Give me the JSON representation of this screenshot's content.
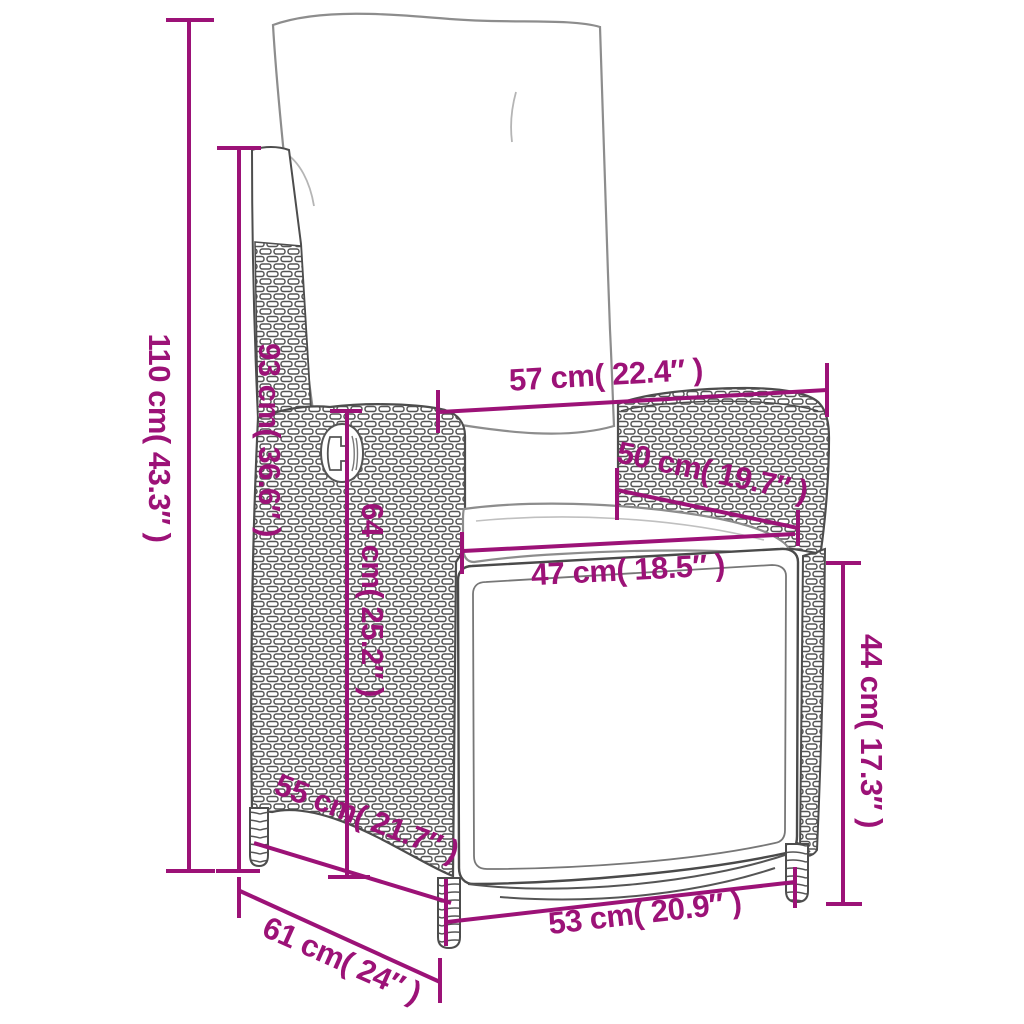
{
  "meta": {
    "type": "product-dimension-diagram",
    "subject": "reclining wicker garden chair with back and seat cushions, line drawing",
    "colors": {
      "dimension_accent": "#9C1277",
      "line_art": "#4d4d4d",
      "background": "#ffffff"
    }
  },
  "dims": [
    {
      "id": "overall-height",
      "label": "110 cm( 43.3″ )"
    },
    {
      "id": "backrest-height",
      "label": "93 cm( 36.6″ )"
    },
    {
      "id": "back-width",
      "label": "57 cm( 22.4″ )"
    },
    {
      "id": "armrest-length",
      "label": "50 cm( 19.7″ )"
    },
    {
      "id": "seat-width",
      "label": "47 cm( 18.5″ )"
    },
    {
      "id": "backrest-inner-height",
      "label": "64 cm( 25.2″ )"
    },
    {
      "id": "side-seat-depth",
      "label": "55 cm( 21.7″ )"
    },
    {
      "id": "overall-depth",
      "label": "61 cm( 24″ )"
    },
    {
      "id": "front-base-width",
      "label": "53 cm( 20.9″ )"
    },
    {
      "id": "seat-height",
      "label": "44 cm( 17.3″ )"
    }
  ]
}
